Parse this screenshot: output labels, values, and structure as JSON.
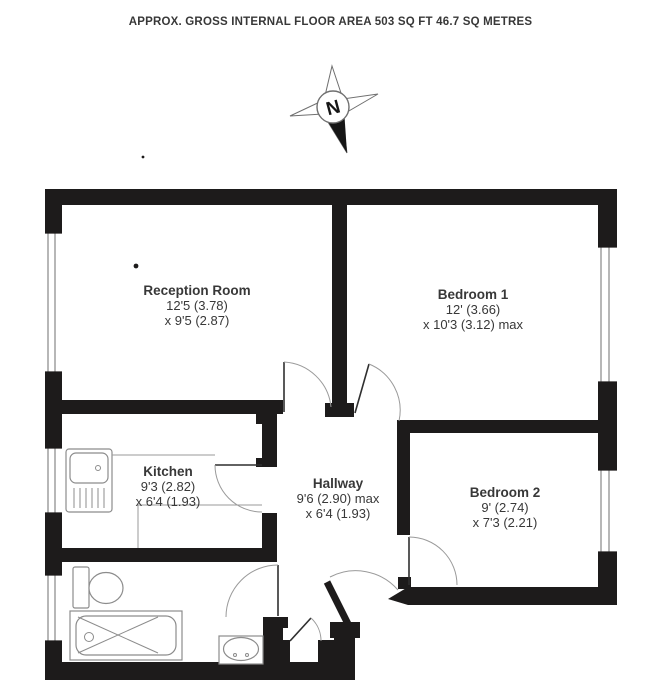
{
  "title": "APPROX. GROSS INTERNAL FLOOR AREA 503 SQ FT 46.7 SQ METRES",
  "compass": {
    "north_label": "N"
  },
  "rooms": [
    {
      "id": "reception",
      "name": "Reception Room",
      "dim1": "12'5 (3.78)",
      "dim2": "x 9'5 (2.87)"
    },
    {
      "id": "bedroom1",
      "name": "Bedroom 1",
      "dim1": "12' (3.66)",
      "dim2": "x 10'3 (3.12) max"
    },
    {
      "id": "kitchen",
      "name": "Kitchen",
      "dim1": "9'3 (2.82)",
      "dim2": "x 6'4 (1.93)"
    },
    {
      "id": "hallway",
      "name": "Hallway",
      "dim1": "9'6 (2.90) max",
      "dim2": "x 6'4 (1.93)"
    },
    {
      "id": "bedroom2",
      "name": "Bedroom 2",
      "dim1": "9' (2.74)",
      "dim2": "x 7'3 (2.21)"
    }
  ],
  "colors": {
    "wall": "#1d1b1b",
    "fixture": "#8c8c8c",
    "text": "#383838",
    "bg": "#ffffff"
  }
}
